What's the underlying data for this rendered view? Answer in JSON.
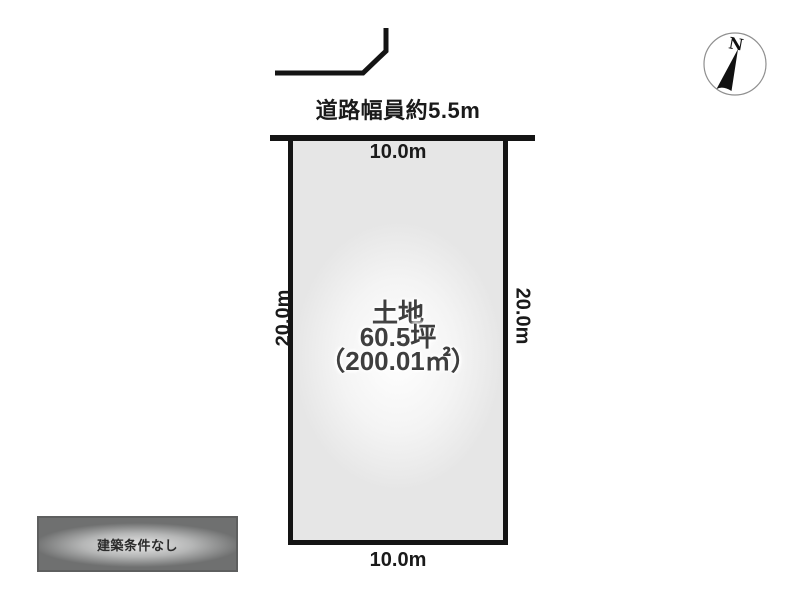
{
  "diagram": {
    "road": {
      "width_label": "道路幅員約5.5m"
    },
    "compass": {
      "north_label": "N"
    },
    "plot": {
      "dimensions": {
        "top": "10.0m",
        "bottom": "10.0m",
        "left": "20.0m",
        "right": "20.0m"
      },
      "area": {
        "type": "土地",
        "tsubo": "60.5坪",
        "square_meters": "（200.01㎡）"
      }
    },
    "badge": {
      "label": "建築条件なし"
    },
    "colors": {
      "line": "#141414",
      "plot_fill": "#e6e6e6",
      "plot_glow": "#ffffff",
      "label_text": "#1a1a1a",
      "area_text": "#3e3e3e",
      "badge_bg": "#6f7070",
      "badge_glow": "#e9e9e9",
      "badge_text": "#2b2b2b"
    }
  }
}
